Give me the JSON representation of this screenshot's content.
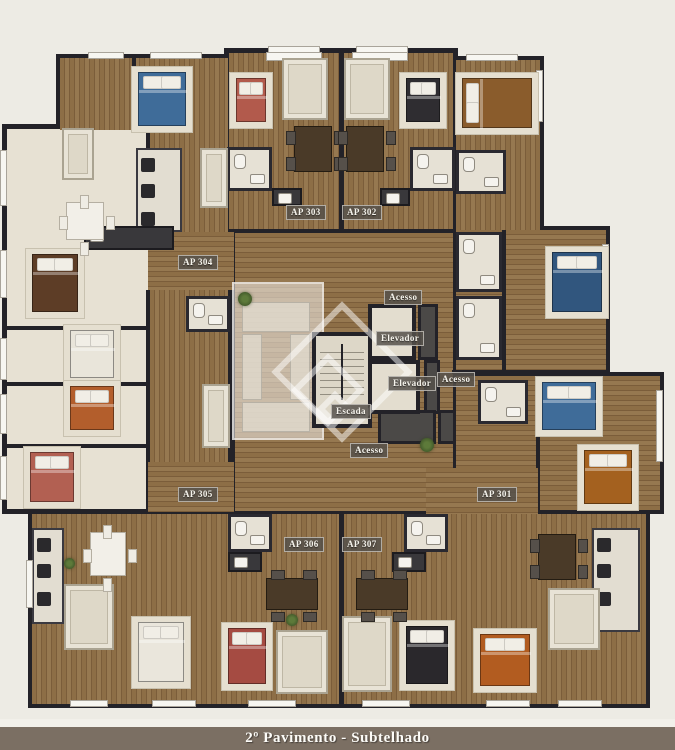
{
  "caption": {
    "text": "2º Pavimento - Subtelhado",
    "bar_color": "#7b6f63",
    "text_color": "#fdfcf8"
  },
  "palette": {
    "background": "#edebe4",
    "wall": "#232228",
    "wood_floor": "#8d6e46",
    "room_floor": "#e7e1d3",
    "label_chip_bg": "#56514b",
    "label_chip_text": "#f6f4ed",
    "bed_blue": "#3f6c99",
    "bed_red": "#b25a4c",
    "bed_orange": "#b35e2c",
    "bed_brown": "#8a5c2c",
    "bed_dark": "#2f2d31",
    "bed_white": "#e9e5da"
  },
  "labels": {
    "apartments": [
      {
        "name": "ap-303",
        "text": "AP 303",
        "left": 286,
        "top": 205
      },
      {
        "name": "ap-302",
        "text": "AP 302",
        "left": 342,
        "top": 205
      },
      {
        "name": "ap-304",
        "text": "AP 304",
        "left": 178,
        "top": 255
      },
      {
        "name": "ap-305",
        "text": "AP 305",
        "left": 178,
        "top": 487
      },
      {
        "name": "ap-301",
        "text": "AP 301",
        "left": 477,
        "top": 487
      },
      {
        "name": "ap-306",
        "text": "AP 306",
        "left": 284,
        "top": 537
      },
      {
        "name": "ap-307",
        "text": "AP 307",
        "left": 342,
        "top": 537
      }
    ],
    "core": [
      {
        "name": "acesso-top",
        "text": "Acesso",
        "left": 384,
        "top": 290
      },
      {
        "name": "elevador-upper",
        "text": "Elevador",
        "left": 376,
        "top": 331
      },
      {
        "name": "elevador-lower",
        "text": "Elevador",
        "left": 388,
        "top": 376
      },
      {
        "name": "acesso-right",
        "text": "Acesso",
        "left": 437,
        "top": 372
      },
      {
        "name": "escada",
        "text": "Escada",
        "left": 331,
        "top": 404
      },
      {
        "name": "acesso-bottom",
        "text": "Acesso",
        "left": 350,
        "top": 443
      }
    ]
  }
}
